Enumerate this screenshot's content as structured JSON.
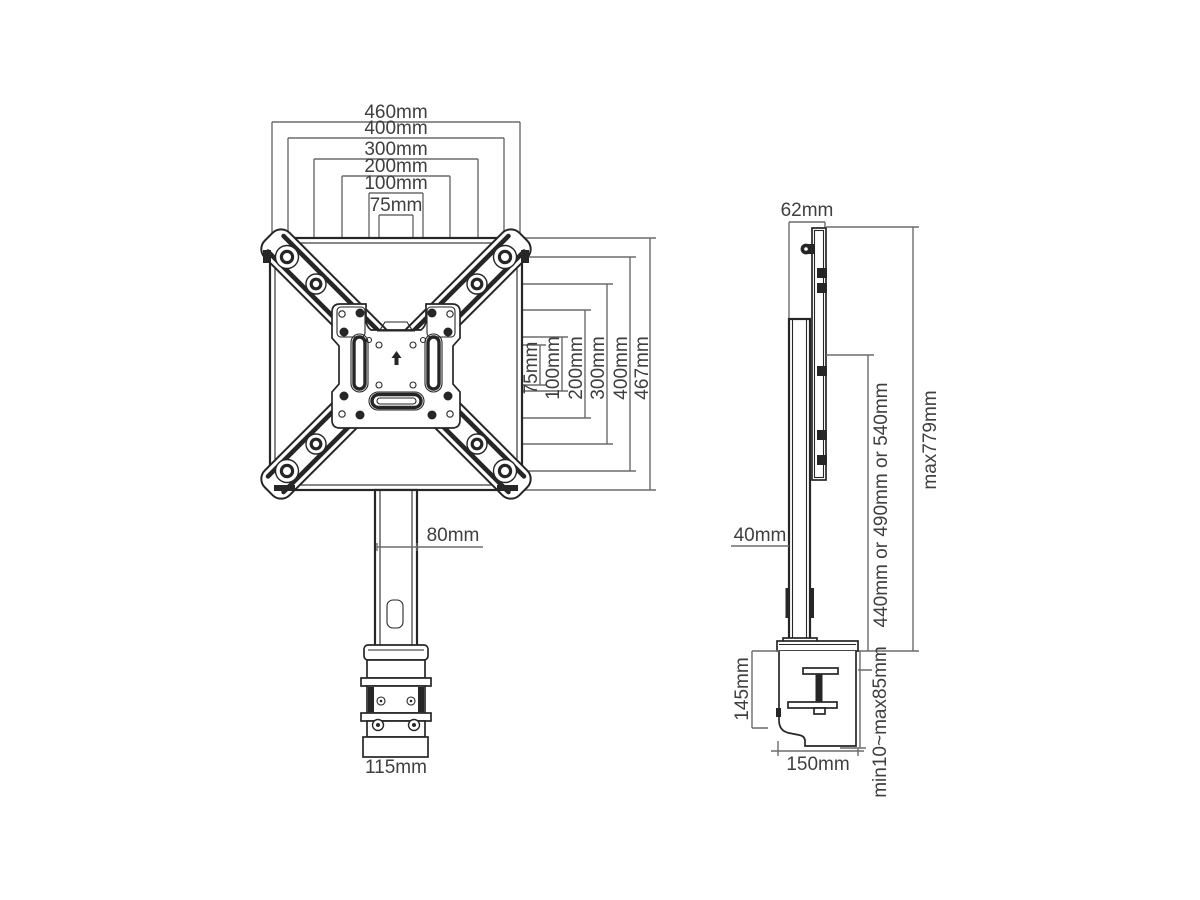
{
  "front": {
    "top_dims": [
      "460mm",
      "400mm",
      "300mm",
      "200mm",
      "100mm",
      "75mm"
    ],
    "side_dims": [
      "75mm",
      "100mm",
      "200mm",
      "300mm",
      "400mm",
      "467mm"
    ],
    "pole_width": "80mm",
    "base_width": "115mm"
  },
  "side": {
    "top_depth": "62mm",
    "pole_depth": "40mm",
    "pole_height_options": "440mm or 490mm or 540mm",
    "max_height": "max779mm",
    "clamp_height": "145mm",
    "clamp_depth": "150mm",
    "clamp_range": "min10~max85mm"
  },
  "colors": {
    "line": "#6b6b6b",
    "ink": "#262626",
    "background": "#ffffff"
  }
}
